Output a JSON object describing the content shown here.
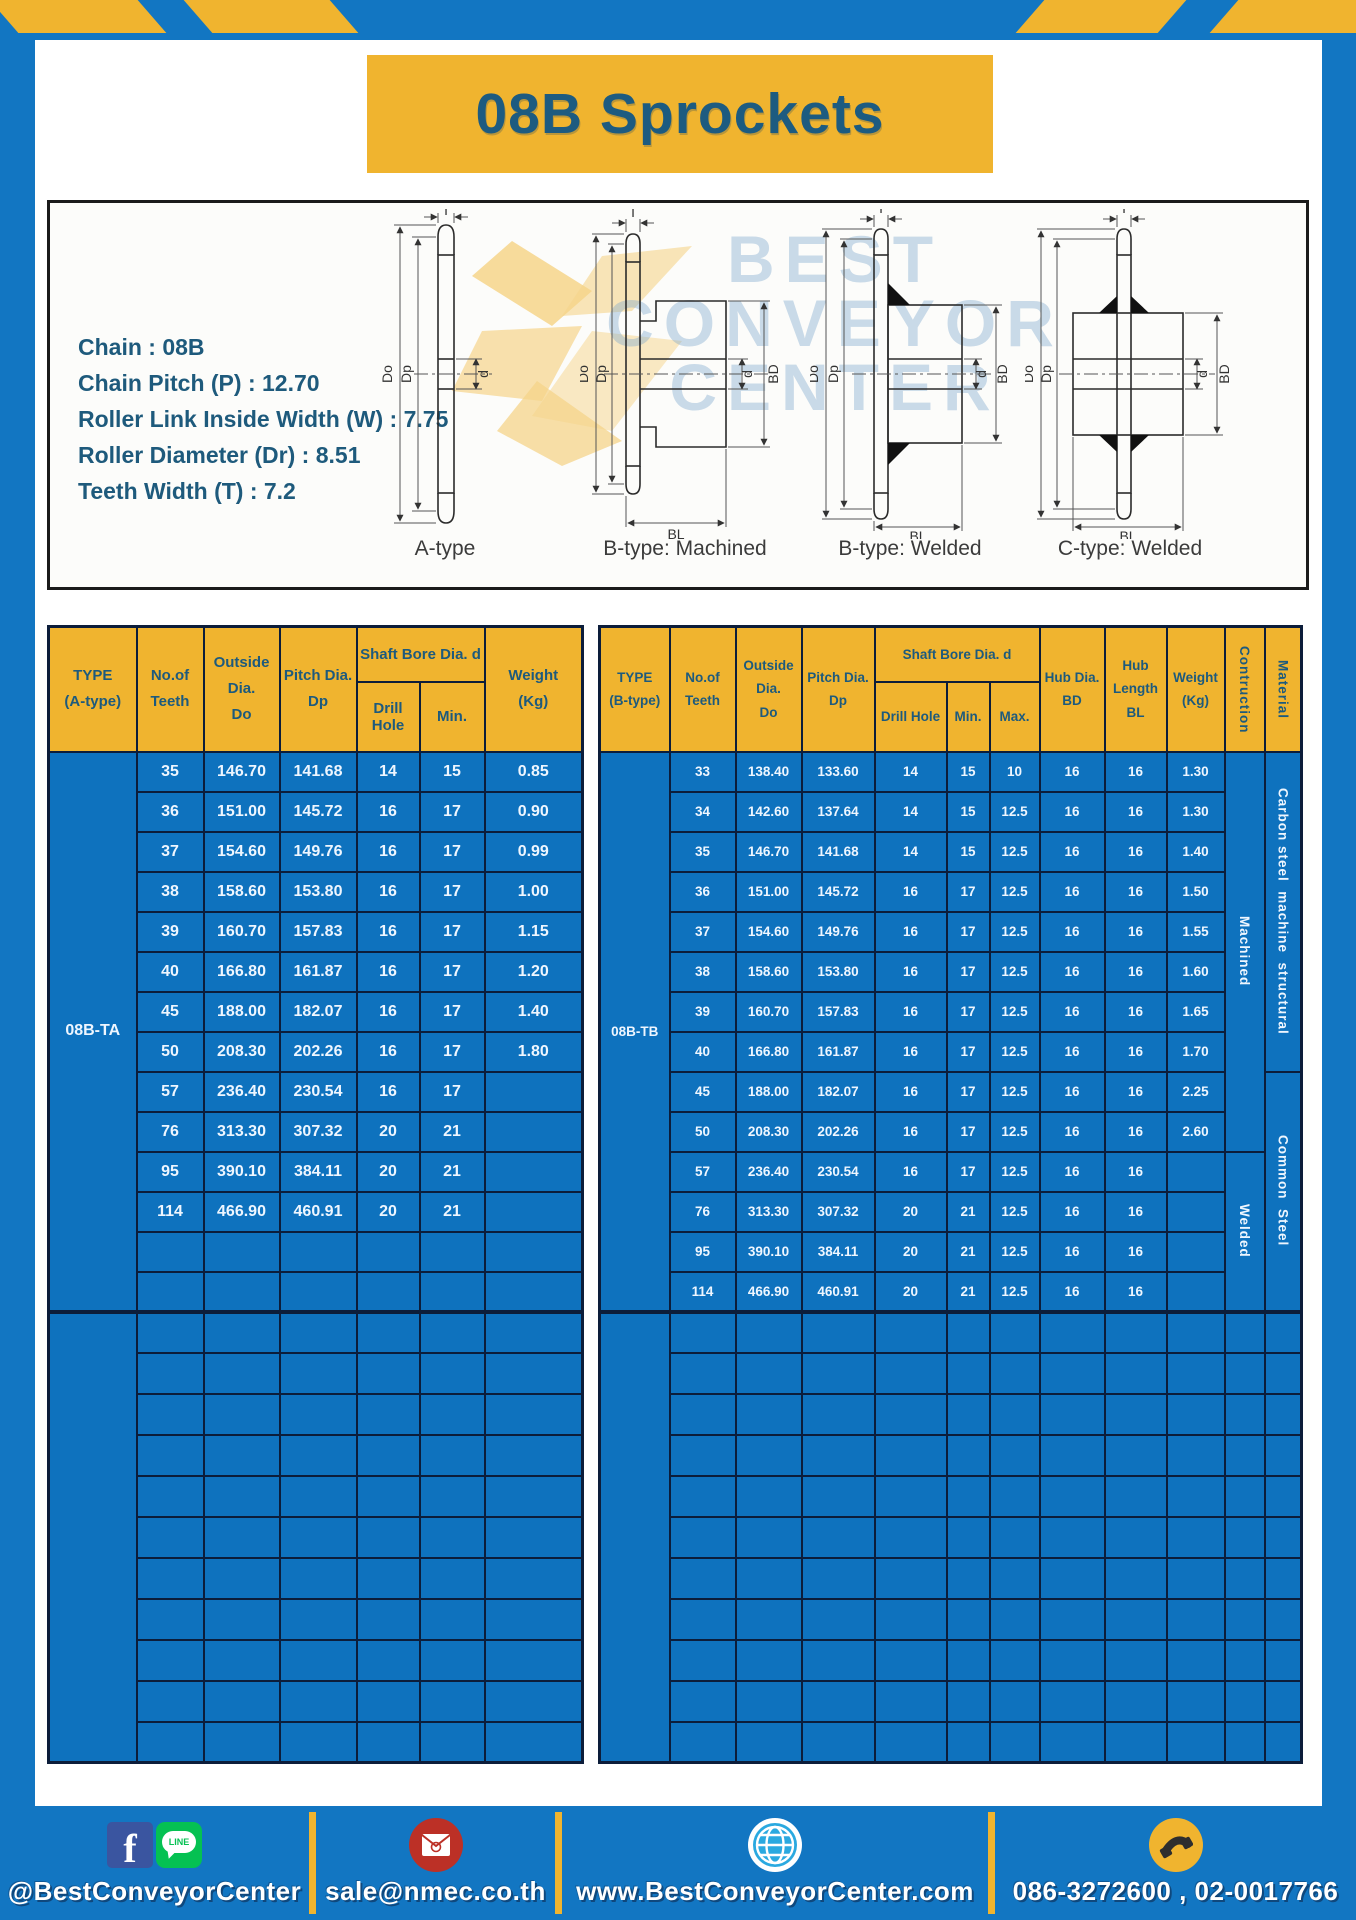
{
  "page": {
    "title": "08B Sprockets",
    "colors": {
      "frame_blue": "#1276c2",
      "accent_yellow": "#f0b42f",
      "table_body_blue": "#0e72be",
      "grid_navy": "#0c1d3a",
      "heading_blue": "#1d5b80"
    }
  },
  "specs": {
    "lines": [
      "Chain : 08B",
      "Chain Pitch (P) : 12.70",
      "Roller Link Inside Width (W) : 7.75",
      "Roller Diameter (Dr) : 8.51",
      "Teeth Width (T) : 7.2"
    ]
  },
  "watermark": {
    "line1": "BEST",
    "line2": "CONVEYOR",
    "line3": "CENTER"
  },
  "diagrams": [
    {
      "label": "A-type",
      "dims": {
        "t": "T",
        "do": "Do",
        "dp": "Dp",
        "d": "d"
      }
    },
    {
      "label": "B-type: Machined",
      "dims": {
        "t": "T",
        "do": "Do",
        "dp": "Dp",
        "d": "d",
        "bd": "BD",
        "bl": "BL"
      }
    },
    {
      "label": "B-type: Welded",
      "dims": {
        "t": "T",
        "do": "Do",
        "dp": "Dp",
        "d": "d",
        "bd": "BD",
        "bl": "BL"
      }
    },
    {
      "label": "C-type: Welded",
      "dims": {
        "t": "T",
        "do": "Do",
        "dp": "Dp",
        "d": "d",
        "bd": "BD",
        "bl": "BL"
      }
    }
  ],
  "table_a": {
    "header": {
      "type_l1": "TYPE",
      "type_l2": "(A-type)",
      "teeth_l1": "No.of",
      "teeth_l2": "Teeth",
      "outside_l1": "Outside",
      "outside_l2": "Dia.",
      "outside_l3": "Do",
      "pitch_l1": "Pitch Dia.",
      "pitch_l2": "Dp",
      "shaft_group": "Shaft Bore Dia. d",
      "drill": "Drill Hole",
      "min": "Min.",
      "weight_l1": "Weight",
      "weight_l2": "(Kg)"
    },
    "type_label": "08B-TA",
    "rows": [
      {
        "teeth": "35",
        "outside": "146.70",
        "pitch": "141.68",
        "drill": "14",
        "min": "15",
        "weight": "0.85"
      },
      {
        "teeth": "36",
        "outside": "151.00",
        "pitch": "145.72",
        "drill": "16",
        "min": "17",
        "weight": "0.90"
      },
      {
        "teeth": "37",
        "outside": "154.60",
        "pitch": "149.76",
        "drill": "16",
        "min": "17",
        "weight": "0.99"
      },
      {
        "teeth": "38",
        "outside": "158.60",
        "pitch": "153.80",
        "drill": "16",
        "min": "17",
        "weight": "1.00"
      },
      {
        "teeth": "39",
        "outside": "160.70",
        "pitch": "157.83",
        "drill": "16",
        "min": "17",
        "weight": "1.15"
      },
      {
        "teeth": "40",
        "outside": "166.80",
        "pitch": "161.87",
        "drill": "16",
        "min": "17",
        "weight": "1.20"
      },
      {
        "teeth": "45",
        "outside": "188.00",
        "pitch": "182.07",
        "drill": "16",
        "min": "17",
        "weight": "1.40"
      },
      {
        "teeth": "50",
        "outside": "208.30",
        "pitch": "202.26",
        "drill": "16",
        "min": "17",
        "weight": "1.80"
      },
      {
        "teeth": "57",
        "outside": "236.40",
        "pitch": "230.54",
        "drill": "16",
        "min": "17",
        "weight": ""
      },
      {
        "teeth": "76",
        "outside": "313.30",
        "pitch": "307.32",
        "drill": "20",
        "min": "21",
        "weight": ""
      },
      {
        "teeth": "95",
        "outside": "390.10",
        "pitch": "384.11",
        "drill": "20",
        "min": "21",
        "weight": ""
      },
      {
        "teeth": "114",
        "outside": "466.90",
        "pitch": "460.91",
        "drill": "20",
        "min": "21",
        "weight": ""
      }
    ],
    "upper_total_rows": 14,
    "lower_empty_rows": 11
  },
  "table_b": {
    "header": {
      "type_l1": "TYPE",
      "type_l2": "(B-type)",
      "teeth_l1": "No.of",
      "teeth_l2": "Teeth",
      "outside_l1": "Outside",
      "outside_l2": "Dia.",
      "outside_l3": "Do",
      "pitch_l1": "Pitch Dia.",
      "pitch_l2": "Dp",
      "shaft_group": "Shaft Bore Dia. d",
      "drill": "Drill Hole",
      "min": "Min.",
      "max": "Max.",
      "hub_dia_l1": "Hub Dia.",
      "hub_dia_l2": "BD",
      "hub_len_l1": "Hub",
      "hub_len_l2": "Length",
      "hub_len_l3": "BL",
      "weight_l1": "Weight",
      "weight_l2": "(Kg)",
      "construction": "Contruction",
      "material": "Material"
    },
    "type_label": "08B-TB",
    "rows": [
      {
        "teeth": "33",
        "outside": "138.40",
        "pitch": "133.60",
        "drill": "14",
        "min": "15",
        "max": "10",
        "hub_dia": "16",
        "hub_len": "16",
        "weight": "1.30"
      },
      {
        "teeth": "34",
        "outside": "142.60",
        "pitch": "137.64",
        "drill": "14",
        "min": "15",
        "max": "12.5",
        "hub_dia": "16",
        "hub_len": "16",
        "weight": "1.30"
      },
      {
        "teeth": "35",
        "outside": "146.70",
        "pitch": "141.68",
        "drill": "14",
        "min": "15",
        "max": "12.5",
        "hub_dia": "16",
        "hub_len": "16",
        "weight": "1.40"
      },
      {
        "teeth": "36",
        "outside": "151.00",
        "pitch": "145.72",
        "drill": "16",
        "min": "17",
        "max": "12.5",
        "hub_dia": "16",
        "hub_len": "16",
        "weight": "1.50"
      },
      {
        "teeth": "37",
        "outside": "154.60",
        "pitch": "149.76",
        "drill": "16",
        "min": "17",
        "max": "12.5",
        "hub_dia": "16",
        "hub_len": "16",
        "weight": "1.55"
      },
      {
        "teeth": "38",
        "outside": "158.60",
        "pitch": "153.80",
        "drill": "16",
        "min": "17",
        "max": "12.5",
        "hub_dia": "16",
        "hub_len": "16",
        "weight": "1.60"
      },
      {
        "teeth": "39",
        "outside": "160.70",
        "pitch": "157.83",
        "drill": "16",
        "min": "17",
        "max": "12.5",
        "hub_dia": "16",
        "hub_len": "16",
        "weight": "1.65"
      },
      {
        "teeth": "40",
        "outside": "166.80",
        "pitch": "161.87",
        "drill": "16",
        "min": "17",
        "max": "12.5",
        "hub_dia": "16",
        "hub_len": "16",
        "weight": "1.70"
      },
      {
        "teeth": "45",
        "outside": "188.00",
        "pitch": "182.07",
        "drill": "16",
        "min": "17",
        "max": "12.5",
        "hub_dia": "16",
        "hub_len": "16",
        "weight": "2.25"
      },
      {
        "teeth": "50",
        "outside": "208.30",
        "pitch": "202.26",
        "drill": "16",
        "min": "17",
        "max": "12.5",
        "hub_dia": "16",
        "hub_len": "16",
        "weight": "2.60"
      },
      {
        "teeth": "57",
        "outside": "236.40",
        "pitch": "230.54",
        "drill": "16",
        "min": "17",
        "max": "12.5",
        "hub_dia": "16",
        "hub_len": "16",
        "weight": ""
      },
      {
        "teeth": "76",
        "outside": "313.30",
        "pitch": "307.32",
        "drill": "20",
        "min": "21",
        "max": "12.5",
        "hub_dia": "16",
        "hub_len": "16",
        "weight": ""
      },
      {
        "teeth": "95",
        "outside": "390.10",
        "pitch": "384.11",
        "drill": "20",
        "min": "21",
        "max": "12.5",
        "hub_dia": "16",
        "hub_len": "16",
        "weight": ""
      },
      {
        "teeth": "114",
        "outside": "466.90",
        "pitch": "460.91",
        "drill": "20",
        "min": "21",
        "max": "12.5",
        "hub_dia": "16",
        "hub_len": "16",
        "weight": ""
      }
    ],
    "construction_spans": [
      {
        "label": "Machined",
        "rows": 10
      },
      {
        "label": "Welded",
        "rows": 4
      }
    ],
    "material_spans": [
      {
        "label": "Carbon steel  machine  structural",
        "rows": 8
      },
      {
        "label": "Common  Steel",
        "rows": 6
      }
    ],
    "upper_total_rows": 14,
    "lower_empty_rows": 11
  },
  "footer": {
    "facebook_letter": "f",
    "line_label": "LINE",
    "social_text": "@BestConveyorCenter",
    "email_text": "sale@nmec.co.th",
    "website_text": "www.BestConveyorCenter.com",
    "phone_text": "086-3272600 , 02-0017766"
  }
}
